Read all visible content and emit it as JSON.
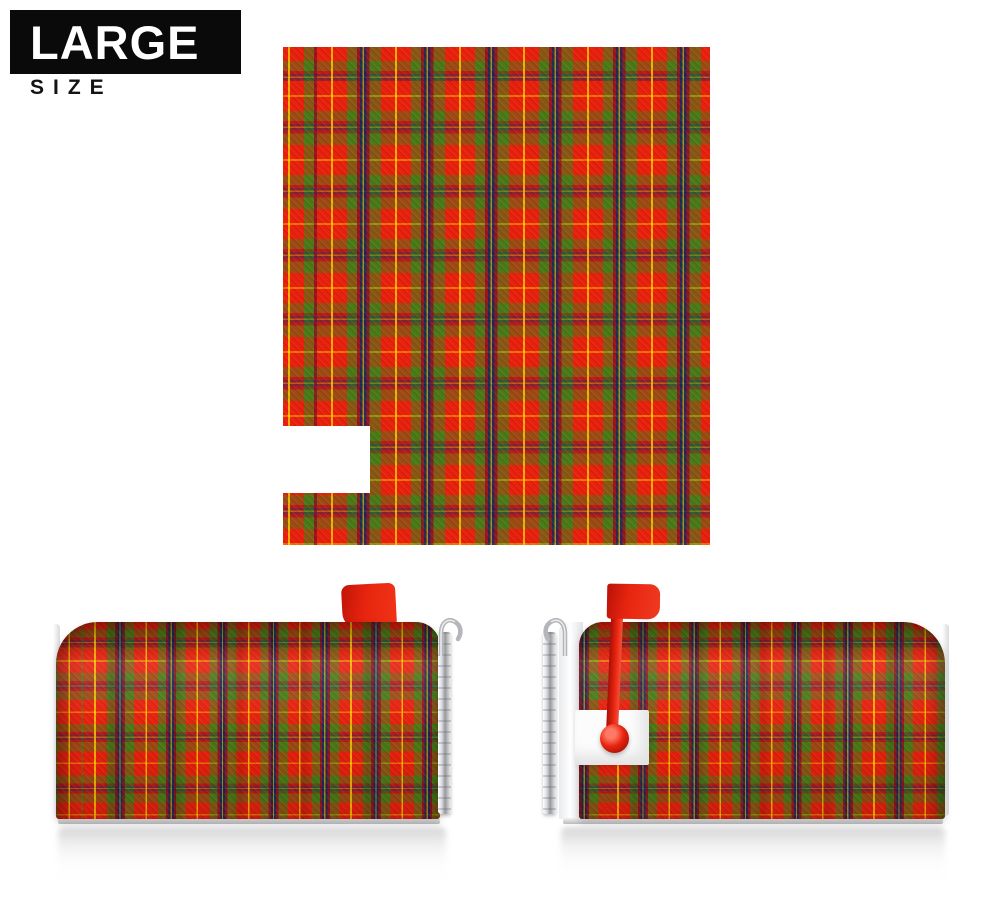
{
  "badge": {
    "title": "LARGE",
    "subtitle": "SIZE"
  },
  "product": {
    "views": {
      "flat_cover": "tartan mailbox cover flat with flag notch cut-out",
      "left_view": "mailbox with cover, flag stowed down",
      "right_view": "mailbox with cover, flag raised up"
    },
    "icons": {
      "flag_down": "mailbox-flag-down-icon",
      "flag_up": "mailbox-flag-up-icon",
      "latch_hook": "latch-hook-icon"
    },
    "colors": {
      "tartan_red": "#e8200c",
      "tartan_green": "#4a7a16",
      "tartan_navy": "#17265c",
      "tartan_maroon": "#8c1025",
      "tartan_yellow": "#ffc400",
      "flag_red": "#e8250f",
      "badge_background": "#0a0a0a",
      "page_background": "#ffffff"
    }
  }
}
